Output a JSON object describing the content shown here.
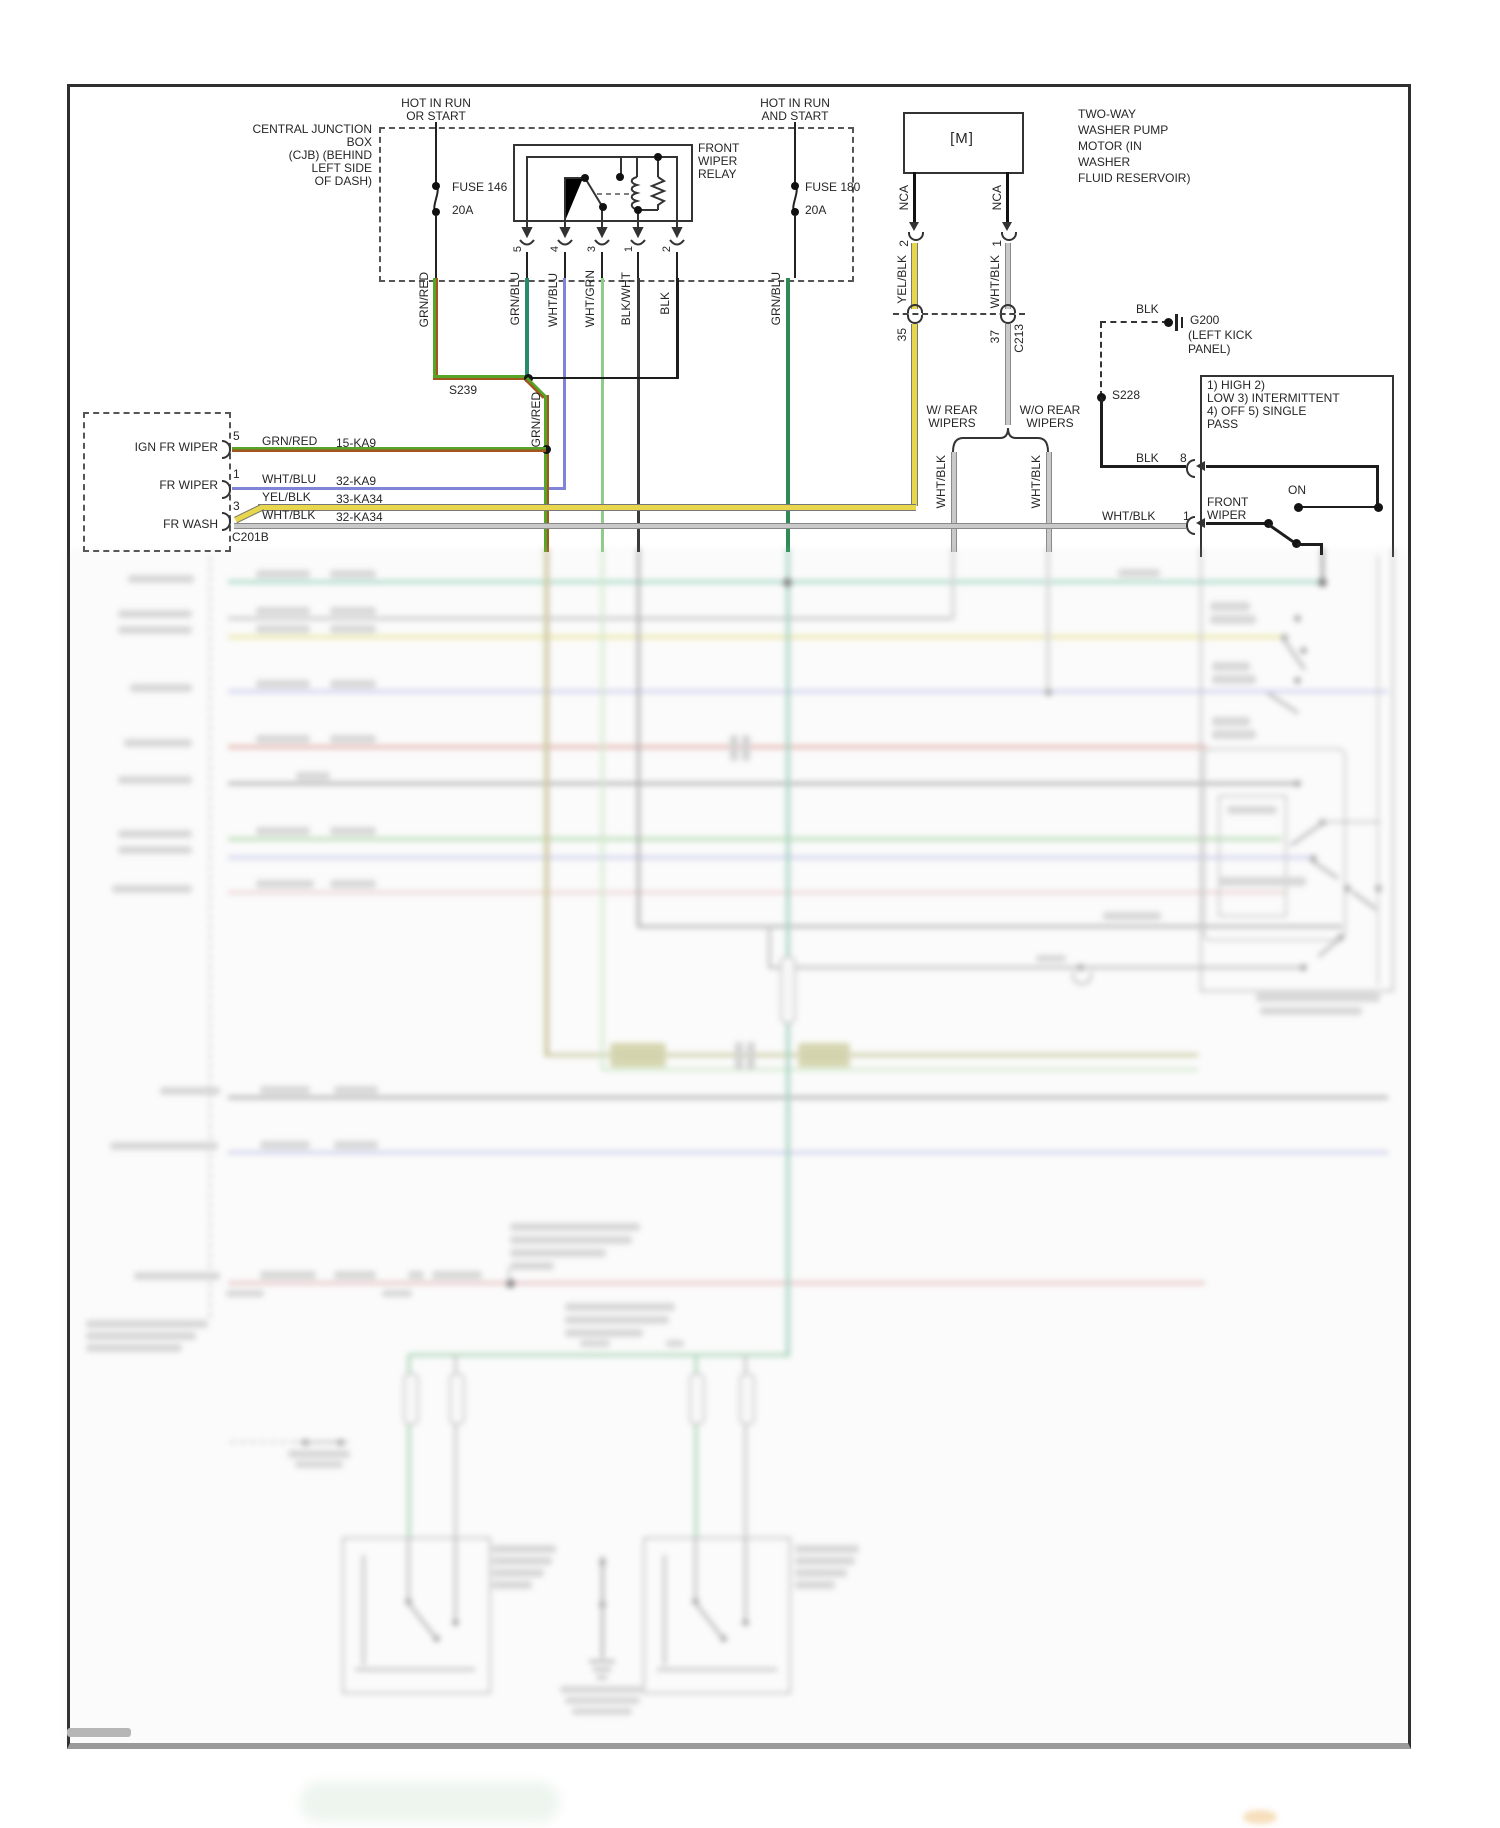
{
  "diagram_type": "automotive wiring diagram - front wiper/washer circuit",
  "power_left": {
    "line1": "HOT IN RUN",
    "line2": "OR START",
    "fuse": "FUSE 146",
    "amps": "20A"
  },
  "power_right": {
    "line1": "HOT IN RUN",
    "line2": "AND START",
    "fuse": "FUSE 180",
    "amps": "20A"
  },
  "cjb": {
    "l1": "CENTRAL JUNCTION",
    "l2": "BOX",
    "l3": "(CJB) (BEHIND",
    "l4": "LEFT SIDE",
    "l5": "OF DASH)"
  },
  "relay": {
    "l1": "FRONT",
    "l2": "WIPER",
    "l3": "RELAY",
    "p5": "5",
    "p4": "4",
    "p3": "3",
    "p1": "1",
    "p2": "2",
    "w5": "GRN/BLU",
    "w4": "WHT/BLU",
    "w3": "WHT/GRN",
    "w1": "BLK/WHT",
    "w2": "BLK"
  },
  "pump": {
    "l1": "TWO-WAY",
    "l2": "WASHER PUMP",
    "l3": "MOTOR (IN",
    "l4": "WASHER",
    "l5": "FLUID RESERVOIR)",
    "m": "[M]",
    "nca_l": "NCA",
    "nca_r": "NCA",
    "pin_l": "2",
    "pin_r": "1",
    "w_l": "YEL/BLK",
    "w_r": "WHT/BLK",
    "c_l": "35",
    "c_r": "37",
    "conn": "C213"
  },
  "branch": {
    "l1": "W/ REAR",
    "l2": "WIPERS",
    "r1": "W/O REAR",
    "r2": "WIPERS",
    "wl": "WHT/BLK",
    "wr": "WHT/BLK"
  },
  "s239": "S239",
  "s228": "S228",
  "g200": {
    "wire": "BLK",
    "n": "G200",
    "l2": "(LEFT KICK",
    "l3": "PANEL)"
  },
  "feed": {
    "grn_red": "GRN/RED",
    "grn_blu": "GRN/BLU",
    "grn_red2": "GRN/RED"
  },
  "c201b": {
    "name": "C201B",
    "r1_sig": "IGN FR WIPER",
    "r1_pin": "5",
    "r1_wire": "GRN/RED",
    "r1_ckt": "15-KA9",
    "r2_sig": "FR WIPER",
    "r2_pin": "1",
    "r2_wire": "WHT/BLU",
    "r2_ckt": "32-KA9",
    "r3_wire": "YEL/BLK",
    "r3_ckt": "33-KA34",
    "r4_sig": "FR WASH",
    "r4_pin": "3",
    "r4_wire": "WHT/BLK",
    "r4_ckt": "32-KA34"
  },
  "switch": {
    "m1": "1) HIGH 2)",
    "m2": "LOW 3) INTERMITTENT",
    "m3": "4) OFF 5) SINGLE",
    "m4": "PASS",
    "on": "ON",
    "n1": "FRONT",
    "n2": "WIPER",
    "in8_wire": "BLK",
    "in8_pin": "8",
    "in1_wire": "WHT/BLK",
    "in1_pin": "1"
  },
  "colors": {
    "grn_red_a": "#56a428",
    "grn_red_b": "#a3571f",
    "grn_blu": "#2a8a6a",
    "wht_blu": "#8184d6",
    "wht_grn": "#8fcb8a",
    "blk_wht": "#3a3a3a",
    "blk": "#1d1d1d",
    "yel_blk": "#e8d74d",
    "wht_blk": "#c0c0c0",
    "grn_blu_fuse180": "#2f8a55"
  }
}
